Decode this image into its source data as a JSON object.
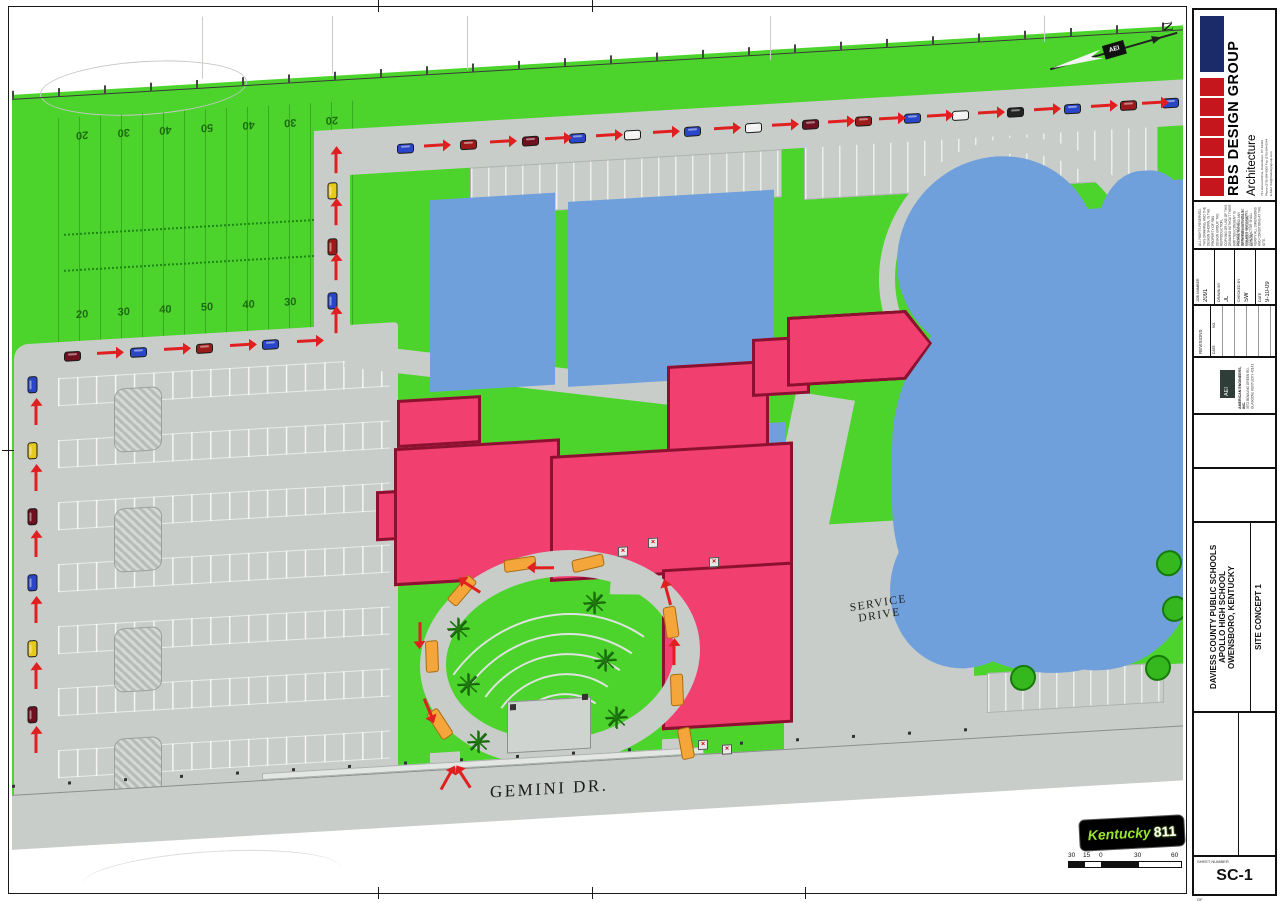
{
  "colors": {
    "grass": "#4cd42d",
    "pavement": "#c9cdca",
    "building_existing": "#6fa0dc",
    "building_addition": "#f13f6f",
    "addition_outline": "#8c1130",
    "route_arrow": "#e02020",
    "bus_orange": "#f4a63a",
    "brand_navy": "#1b2a68",
    "brand_red": "#c4161c",
    "ky811_green": "#9ae32c"
  },
  "plan": {
    "labels": {
      "gemini": "GEMINI DR.",
      "service1": "SERVICE",
      "service2": "DRIVE"
    },
    "north": {
      "n": "N",
      "hub": "AEI"
    },
    "ky811": {
      "brand": "Kentucky",
      "number": "811"
    },
    "scalebar": {
      "labels": [
        {
          "t": "30",
          "x": 0
        },
        {
          "t": "15",
          "x": 15
        },
        {
          "t": "0",
          "x": 31
        },
        {
          "t": "30",
          "x": 66
        },
        {
          "t": "60",
          "x": 103
        }
      ]
    },
    "field_numbers_top": [
      {
        "t": "20"
      },
      {
        "t": "30"
      },
      {
        "t": "40"
      },
      {
        "t": "50"
      },
      {
        "t": "40"
      },
      {
        "t": "30"
      },
      {
        "t": "20"
      }
    ],
    "field_numbers_bottom": [
      {
        "t": "20"
      },
      {
        "t": "30"
      },
      {
        "t": "40"
      },
      {
        "t": "50"
      },
      {
        "t": "40"
      },
      {
        "t": "30"
      },
      {
        "t": "20"
      }
    ],
    "cars_top": [
      {
        "x": 385,
        "y": 124,
        "c": "#2a46c8"
      },
      {
        "x": 448,
        "y": 124,
        "c": "#9b1b1b"
      },
      {
        "x": 510,
        "y": 124,
        "c": "#6e1020"
      },
      {
        "x": 557,
        "y": 124,
        "c": "#2a46c8"
      },
      {
        "x": 612,
        "y": 124,
        "c": "#f2f2f2"
      },
      {
        "x": 672,
        "y": 124,
        "c": "#2a46c8"
      },
      {
        "x": 733,
        "y": 124,
        "c": "#f2f2f2"
      },
      {
        "x": 790,
        "y": 124,
        "c": "#6e1020"
      },
      {
        "x": 843,
        "y": 124,
        "c": "#9b1b1b"
      },
      {
        "x": 892,
        "y": 124,
        "c": "#2a46c8"
      },
      {
        "x": 940,
        "y": 124,
        "c": "#f2f2f2"
      },
      {
        "x": 995,
        "y": 124,
        "c": "#222222"
      },
      {
        "x": 1052,
        "y": 124,
        "c": "#2a46c8"
      },
      {
        "x": 1108,
        "y": 124,
        "c": "#9b1b1b"
      },
      {
        "x": 1150,
        "y": 124,
        "c": "#2a46c8"
      }
    ],
    "arrows_top": [
      {
        "x": 412,
        "y": 126
      },
      {
        "x": 478,
        "y": 126
      },
      {
        "x": 533,
        "y": 126
      },
      {
        "x": 584,
        "y": 126
      },
      {
        "x": 641,
        "y": 126
      },
      {
        "x": 702,
        "y": 126
      },
      {
        "x": 760,
        "y": 126
      },
      {
        "x": 816,
        "y": 126
      },
      {
        "x": 867,
        "y": 126
      },
      {
        "x": 915,
        "y": 126
      },
      {
        "x": 966,
        "y": 126
      },
      {
        "x": 1022,
        "y": 126
      },
      {
        "x": 1079,
        "y": 126
      },
      {
        "x": 1130,
        "y": 126
      }
    ],
    "cars_left": [
      {
        "x": 12,
        "y": 338,
        "r": -90,
        "c": "#2a46c8"
      },
      {
        "x": 12,
        "y": 404,
        "r": -90,
        "c": "#e6c91e"
      },
      {
        "x": 12,
        "y": 470,
        "r": -90,
        "c": "#6e1020"
      },
      {
        "x": 12,
        "y": 536,
        "r": -90,
        "c": "#2a46c8"
      },
      {
        "x": 12,
        "y": 602,
        "r": -90,
        "c": "#e6c91e"
      },
      {
        "x": 12,
        "y": 668,
        "r": -90,
        "c": "#6e1020"
      }
    ],
    "arrows_left": [
      {
        "x": 14,
        "y": 372,
        "r": -90
      },
      {
        "x": 14,
        "y": 438,
        "r": -90
      },
      {
        "x": 14,
        "y": 504,
        "r": -90
      },
      {
        "x": 14,
        "y": 570,
        "r": -90
      },
      {
        "x": 14,
        "y": 636,
        "r": -90
      },
      {
        "x": 14,
        "y": 700,
        "r": -90
      }
    ],
    "cars_mid": [
      {
        "x": 52,
        "y": 312,
        "c": "#6e1020"
      },
      {
        "x": 118,
        "y": 312,
        "c": "#2a46c8"
      },
      {
        "x": 184,
        "y": 312,
        "c": "#9b1b1b"
      },
      {
        "x": 250,
        "y": 312,
        "c": "#2a46c8"
      }
    ],
    "arrows_mid": [
      {
        "x": 85,
        "y": 314
      },
      {
        "x": 152,
        "y": 314
      },
      {
        "x": 218,
        "y": 314
      },
      {
        "x": 285,
        "y": 314
      }
    ],
    "cars_conn": [
      {
        "x": 312,
        "y": 162,
        "r": -90,
        "c": "#e6c91e"
      },
      {
        "x": 312,
        "y": 218,
        "r": -90,
        "c": "#9b1b1b"
      },
      {
        "x": 312,
        "y": 272,
        "r": -90,
        "c": "#2a46c8"
      }
    ],
    "arrows_conn": [
      {
        "x": 314,
        "y": 138,
        "r": -90
      },
      {
        "x": 314,
        "y": 190,
        "r": -90
      },
      {
        "x": 314,
        "y": 245,
        "r": -90
      },
      {
        "x": 314,
        "y": 298,
        "r": -90
      }
    ],
    "buses": [
      {
        "x": 560,
        "y": 548,
        "r": -10
      },
      {
        "x": 492,
        "y": 545,
        "r": -5
      },
      {
        "x": 434,
        "y": 568,
        "r": -48
      },
      {
        "x": 404,
        "y": 632,
        "r": 88
      },
      {
        "x": 412,
        "y": 700,
        "r": 58
      },
      {
        "x": 643,
        "y": 612,
        "r": 82
      },
      {
        "x": 649,
        "y": 680,
        "r": 88
      },
      {
        "x": 658,
        "y": 734,
        "r": 80
      }
    ],
    "loop_arrows": [
      {
        "x": 522,
        "y": 555,
        "r": 183
      },
      {
        "x": 450,
        "y": 570,
        "r": 215
      },
      {
        "x": 398,
        "y": 612,
        "r": 90
      },
      {
        "x": 406,
        "y": 688,
        "r": 68
      },
      {
        "x": 652,
        "y": 650,
        "r": -90
      },
      {
        "x": 646,
        "y": 590,
        "r": -105
      }
    ],
    "entrance_arrows": [
      {
        "x": 424,
        "y": 762,
        "r": -60
      },
      {
        "x": 443,
        "y": 762,
        "r": 238
      }
    ],
    "trees": [
      {
        "x": 446,
        "y": 614,
        "t": "✳"
      },
      {
        "x": 456,
        "y": 670,
        "t": "✳"
      },
      {
        "x": 466,
        "y": 728,
        "t": "✳"
      },
      {
        "x": 582,
        "y": 596,
        "t": "✳"
      },
      {
        "x": 593,
        "y": 654,
        "t": "✳"
      },
      {
        "x": 604,
        "y": 712,
        "t": "✳"
      }
    ],
    "bushes": [
      {
        "x": 998,
        "y": 682
      },
      {
        "x": 1133,
        "y": 680
      },
      {
        "x": 1150,
        "y": 622
      },
      {
        "x": 1144,
        "y": 576
      }
    ],
    "markers": [
      {
        "x": 606,
        "y": 540,
        "t": "×"
      },
      {
        "x": 636,
        "y": 533,
        "t": "×"
      },
      {
        "x": 697,
        "y": 556,
        "t": "×"
      },
      {
        "x": 686,
        "y": 738,
        "t": "×"
      },
      {
        "x": 710,
        "y": 744,
        "t": "×"
      }
    ]
  },
  "titleblock": {
    "firm": {
      "name": "RBS DESIGN GROUP",
      "discipline": "Architecture",
      "address": "731 Harvard Drive, Owensboro, KY 42301",
      "phone": "Phone (270) 684-0505  Fax (270) 684-0544",
      "email": "E-Mail: rbs@rbsdesigngroup.com"
    },
    "copyright": {
      "p1": "ALL RIGHTS RESERVED. THIS DRAWING, AND THE DESIGN SHOWN, IS THE PROPERTY OF RBS DESIGN GROUP. THE REPRODUCTION, COPYING OR USE OF THIS DRAWING WITHOUT THEIR WRITTEN CONSENT IS PROHIBITED AND ANY INFRINGEMENT WILL BE SUBJECT TO LEGAL ACTION.",
      "p2": "DO NOT SCALE DRAWINGS. USE ONLY FIGURED DIMENSIONS. CONTRACTOR SHALL VERIFY ALL DIMENSIONS AND CONDITIONS AT THE SITE."
    },
    "fields": {
      "job_label": "JOB NUMBER",
      "job_value": "2091",
      "drawn_label": "DRAWN BY",
      "drawn_value": "JL",
      "checked_label": "CHECKED BY",
      "checked_value": "SW",
      "date_label": "DATE",
      "date_value": "9-10-09"
    },
    "revisions": {
      "label": "REVISIONS",
      "col_no": "NO.",
      "col_date": "DATE"
    },
    "engineer": {
      "abbr": "AEI",
      "name": "AMERICAN ENGINEERS, INC.",
      "address": "3572 BOWLING GREEN RD. GLASGOW, KENTUCKY 42141"
    },
    "project": {
      "line1": "DAVIESS COUNTY PUBLIC SCHOOLS",
      "line2": "APOLLO HIGH SCHOOL",
      "line3": "OWENSBORO, KENTUCKY",
      "concept": "SITE CONCEPT 1"
    },
    "sheet": {
      "label": "SHEET NUMBER",
      "number": "SC-1",
      "of": "OF"
    }
  }
}
